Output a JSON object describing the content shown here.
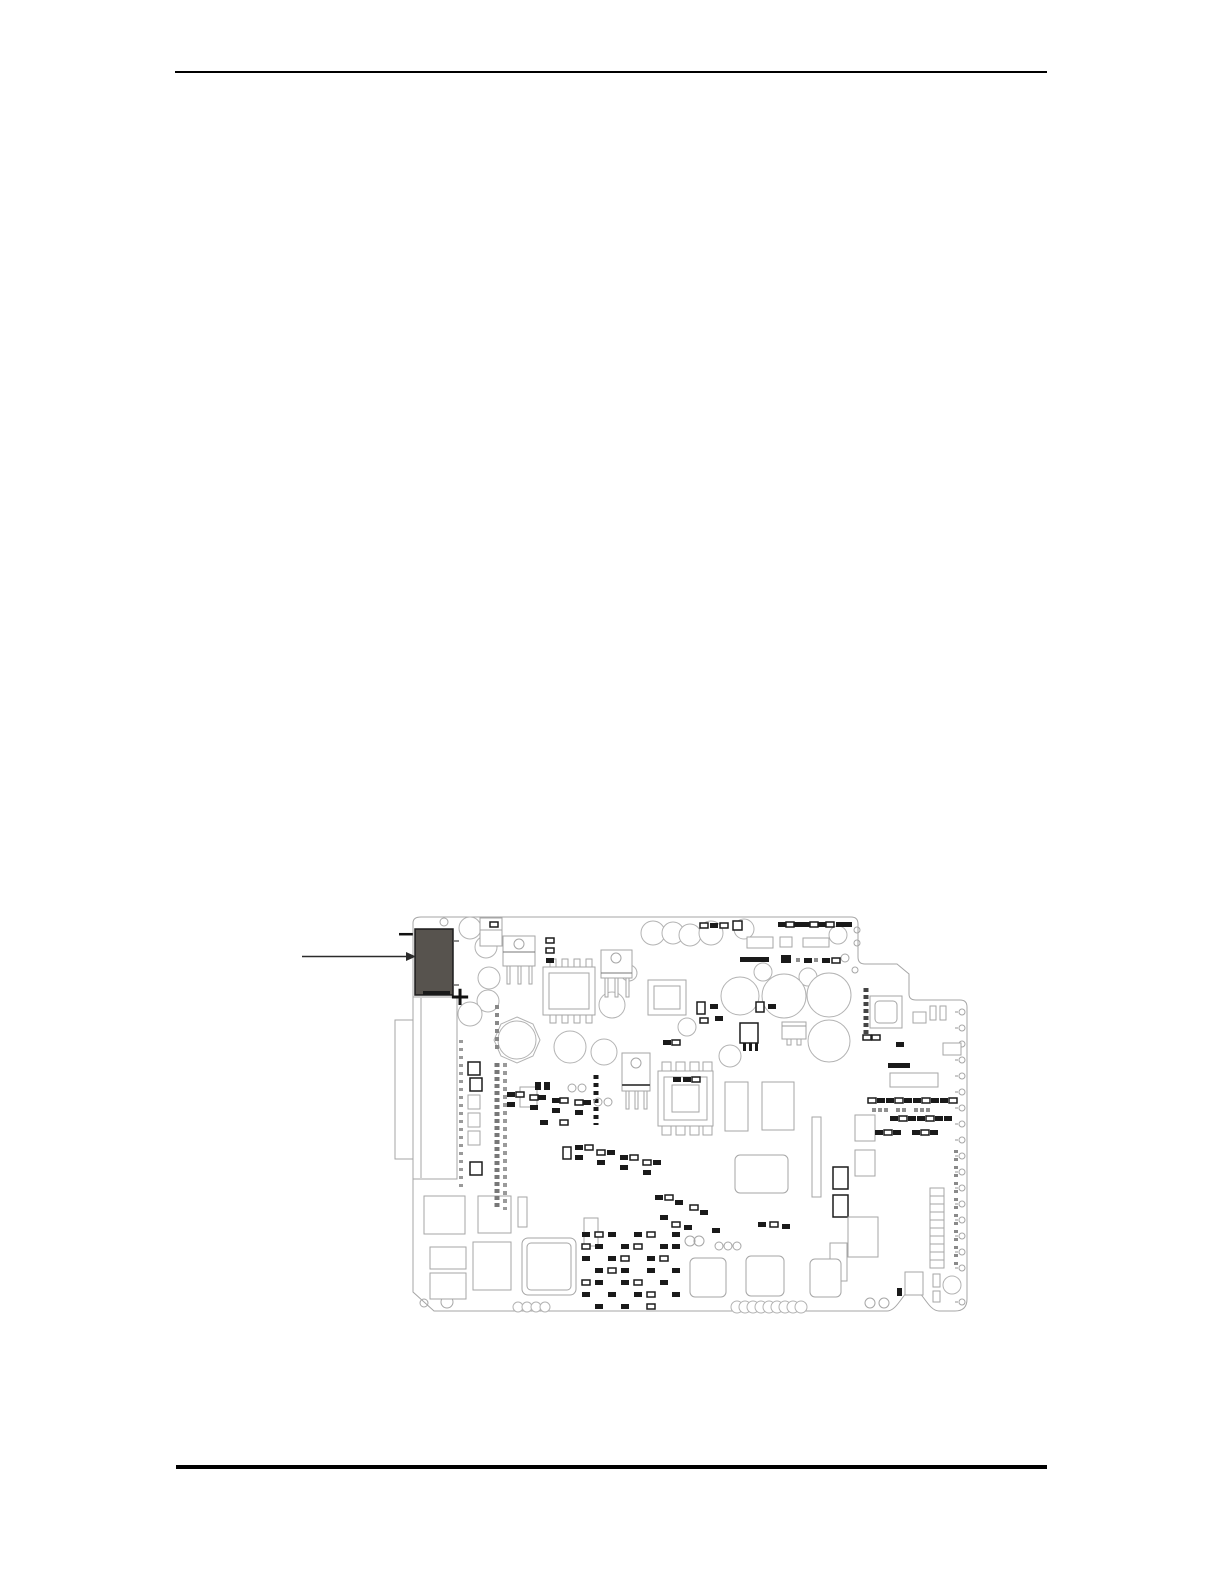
{
  "document": {
    "page_background": "#ffffff",
    "header_rule": {
      "color": "#000000"
    },
    "footer_rule": {
      "color": "#000000"
    }
  },
  "figure": {
    "name": "circuit-board-component-location-diagram",
    "kind": "pcb-line-art-illustration",
    "board_outline_color": "#a6a6a6",
    "component_line_color": "#1c1c1c",
    "callout": {
      "arrow_color": "#2b2b2b",
      "target": "highlighted-connector",
      "highlight_fill": "#57534e",
      "polarity_minus": "−",
      "polarity_plus": "+"
    }
  }
}
